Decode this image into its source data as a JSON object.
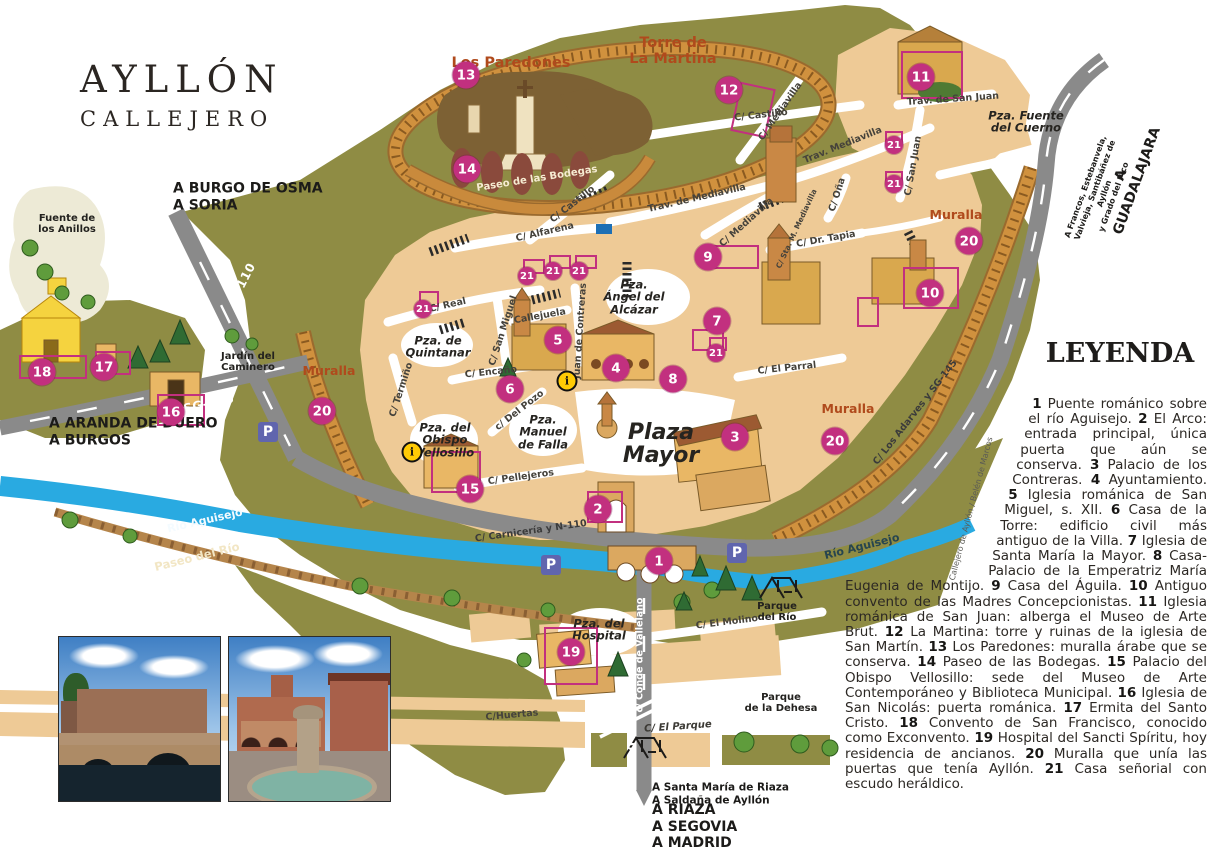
{
  "title": {
    "line1": "AYLLÓN",
    "line2": "CALLEJERO"
  },
  "legend": {
    "title": "LEYENDA",
    "items": [
      {
        "num": "1",
        "text": "Puente románico sobre el río Aguisejo."
      },
      {
        "num": "2",
        "text": "El Arco: entrada principal, única puerta que aún se conserva."
      },
      {
        "num": "3",
        "text": "Palacio de los Contreras."
      },
      {
        "num": "4",
        "text": "Ayuntamiento."
      },
      {
        "num": "5",
        "text": "Iglesia románica de San Miguel, s. XII."
      },
      {
        "num": "6",
        "text": "Casa de la Torre: edificio civil más antiguo de la Villa."
      },
      {
        "num": "7",
        "text": "Iglesia de Santa María la Mayor."
      },
      {
        "num": "8",
        "text": "Casa-Palacio de la Emperatriz María Eugenia de Montijo."
      },
      {
        "num": "9",
        "text": "Casa del Águila."
      },
      {
        "num": "10",
        "text": "Antiguo convento de las Madres Concepcionistas."
      },
      {
        "num": "11",
        "text": "Iglesia románica de San Juan: alberga el Museo de Arte Brut."
      },
      {
        "num": "12",
        "text": "La Martina: torre y ruinas de la iglesia de San Martín."
      },
      {
        "num": "13",
        "text": "Los Paredones: muralla árabe que se conserva."
      },
      {
        "num": "14",
        "text": "Paseo de las Bodegas."
      },
      {
        "num": "15",
        "text": "Palacio del Obispo Vellosillo: sede del Museo de Arte Contemporáneo y Biblioteca Municipal."
      },
      {
        "num": "16",
        "text": "Iglesia de San Nicolás: puerta románica."
      },
      {
        "num": "17",
        "text": "Ermita del Santo Cristo."
      },
      {
        "num": "18",
        "text": "Convento de San Francisco, conocido como Exconvento."
      },
      {
        "num": "19",
        "text": "Hospital del Sancti Spíritu, hoy residencia de ancianos."
      },
      {
        "num": "20",
        "text": "Muralla que unía las puertas que tenía Ayllón."
      },
      {
        "num": "21",
        "text": "Casa señorial con escudo heráldico."
      }
    ]
  },
  "colors": {
    "olive": "#8f8c44",
    "tan": "#eeca96",
    "muralla": "#d0913e",
    "muralla_dark": "#9a6a2e",
    "road": "#8a8a8a",
    "river": "#29aae1",
    "marker_pink": "#c2307f",
    "label_red": "#b04a1c",
    "parking_blue": "#6065ae",
    "info_yellow": "#ffcb05",
    "hill_brown": "#7d6134",
    "path_brown": "#b5854b",
    "building_gold": "#e9b765",
    "church_yellow": "#f5d33f",
    "tree_green": "#5f9c3c",
    "conifer_green": "#2f6b33"
  },
  "map": {
    "markers_large": [
      {
        "n": "1",
        "x": 659,
        "y": 561
      },
      {
        "n": "2",
        "x": 598,
        "y": 509
      },
      {
        "n": "3",
        "x": 735,
        "y": 437
      },
      {
        "n": "4",
        "x": 616,
        "y": 368
      },
      {
        "n": "5",
        "x": 558,
        "y": 340
      },
      {
        "n": "6",
        "x": 510,
        "y": 389
      },
      {
        "n": "7",
        "x": 717,
        "y": 321
      },
      {
        "n": "8",
        "x": 673,
        "y": 379
      },
      {
        "n": "9",
        "x": 708,
        "y": 257
      },
      {
        "n": "10",
        "x": 930,
        "y": 293
      },
      {
        "n": "11",
        "x": 921,
        "y": 77
      },
      {
        "n": "12",
        "x": 729,
        "y": 90
      },
      {
        "n": "13",
        "x": 466,
        "y": 75
      },
      {
        "n": "14",
        "x": 467,
        "y": 169
      },
      {
        "n": "15",
        "x": 470,
        "y": 489
      },
      {
        "n": "16",
        "x": 171,
        "y": 412
      },
      {
        "n": "17",
        "x": 104,
        "y": 367
      },
      {
        "n": "18",
        "x": 42,
        "y": 372
      },
      {
        "n": "19",
        "x": 571,
        "y": 652
      },
      {
        "n": "20",
        "x": 322,
        "y": 411
      },
      {
        "n": "20",
        "x": 835,
        "y": 441
      },
      {
        "n": "20",
        "x": 969,
        "y": 241
      }
    ],
    "markers_small": [
      {
        "n": "21",
        "x": 423,
        "y": 309
      },
      {
        "n": "21",
        "x": 527,
        "y": 276
      },
      {
        "n": "21",
        "x": 553,
        "y": 271
      },
      {
        "n": "21",
        "x": 579,
        "y": 271
      },
      {
        "n": "21",
        "x": 716,
        "y": 353
      },
      {
        "n": "21",
        "x": 894,
        "y": 145
      },
      {
        "n": "21",
        "x": 894,
        "y": 184
      }
    ],
    "info_icons": [
      {
        "x": 567,
        "y": 381
      },
      {
        "x": 412,
        "y": 452
      }
    ],
    "parking_icons": [
      {
        "x": 268,
        "y": 432
      },
      {
        "x": 551,
        "y": 565
      },
      {
        "x": 737,
        "y": 553
      }
    ],
    "labels": [
      {
        "text": "Paseo de las Bodegas",
        "x": 537,
        "y": 179,
        "rot": -9,
        "cls": "bodegas"
      },
      {
        "text": "C/ Castillo",
        "x": 573,
        "y": 205,
        "rot": -38,
        "cls": "street"
      },
      {
        "text": "C/ Castillo",
        "x": 761,
        "y": 116,
        "rot": -6,
        "cls": "street"
      },
      {
        "text": "Trav. de Mediavilla",
        "x": 697,
        "y": 199,
        "rot": -13,
        "cls": "street"
      },
      {
        "text": "Trav. Mediavilla",
        "x": 843,
        "y": 146,
        "rot": -22,
        "cls": "street"
      },
      {
        "text": "C/ Mediavilla",
        "x": 781,
        "y": 112,
        "rot": -55,
        "cls": "street"
      },
      {
        "text": "C/ Mediavilla",
        "x": 747,
        "y": 223,
        "rot": -42,
        "cls": "street"
      },
      {
        "text": "C/ Oña",
        "x": 838,
        "y": 195,
        "rot": -72,
        "cls": "street"
      },
      {
        "text": "C/ Sta. M. Mediavilla",
        "x": 797,
        "y": 229,
        "rot": -65,
        "cls": "street-tiny"
      },
      {
        "text": "C/ Dr. Tapia",
        "x": 826,
        "y": 240,
        "rot": -10,
        "cls": "street"
      },
      {
        "text": "C/ San Juan",
        "x": 914,
        "y": 166,
        "rot": -80,
        "cls": "street"
      },
      {
        "text": "Trav. de San Juan",
        "x": 953,
        "y": 100,
        "rot": -4,
        "cls": "street"
      },
      {
        "text": "C/ Alfarena",
        "x": 545,
        "y": 233,
        "rot": -13,
        "cls": "street"
      },
      {
        "text": "C/ Real",
        "x": 448,
        "y": 306,
        "rot": -13,
        "cls": "street"
      },
      {
        "text": "C/ San Miguel",
        "x": 504,
        "y": 331,
        "rot": -72,
        "cls": "street"
      },
      {
        "text": "Callejuela",
        "x": 540,
        "y": 317,
        "rot": -10,
        "cls": "street"
      },
      {
        "text": "Juan de Contreras",
        "x": 581,
        "y": 331,
        "rot": -86,
        "cls": "street"
      },
      {
        "text": "C/ Encaño",
        "x": 491,
        "y": 373,
        "rot": -6,
        "cls": "street"
      },
      {
        "text": "c/ Del Pozo",
        "x": 520,
        "y": 411,
        "rot": -38,
        "cls": "street"
      },
      {
        "text": "C/ Termiño",
        "x": 402,
        "y": 390,
        "rot": -72,
        "cls": "street"
      },
      {
        "text": "C/ Pellejeros",
        "x": 521,
        "y": 478,
        "rot": -8,
        "cls": "street"
      },
      {
        "text": "C/ El Parral",
        "x": 787,
        "y": 369,
        "rot": -6,
        "cls": "street"
      },
      {
        "text": "C/ El Molino",
        "x": 727,
        "y": 623,
        "rot": -7,
        "cls": "street"
      },
      {
        "text": "C/Huertas",
        "x": 512,
        "y": 716,
        "rot": -5,
        "cls": "street"
      },
      {
        "text": "C/ El Parque",
        "x": 678,
        "y": 727,
        "rot": -4,
        "cls": "street-it"
      },
      {
        "text": "C/ Carnicería y N-110",
        "x": 531,
        "y": 532,
        "rot": -8,
        "cls": "road-dark"
      },
      {
        "text": "C/ Los Adarves y SG-145",
        "x": 916,
        "y": 413,
        "rot": -52,
        "cls": "road-dark"
      },
      {
        "text": "N-110",
        "x": 243,
        "y": 283,
        "rot": -63,
        "cls": "road-label"
      },
      {
        "text": "SG-945",
        "x": 209,
        "y": 404,
        "rot": -12,
        "cls": "road-label"
      },
      {
        "text": "c/ Conde de Vallelano",
        "x": 641,
        "y": 655,
        "rot": -90,
        "cls": "road-label-sm"
      },
      {
        "text": "N-110",
        "x": 633,
        "y": 763,
        "rot": -90,
        "cls": "road-label"
      },
      {
        "text": "Río Aguisejo",
        "x": 205,
        "y": 521,
        "rot": -13,
        "cls": "river-label"
      },
      {
        "text": "Río Aguisejo",
        "x": 862,
        "y": 547,
        "rot": -14,
        "cls": "river-label-dark"
      },
      {
        "text": "Paseo del Río",
        "x": 197,
        "y": 557,
        "rot": -14,
        "cls": "path-label"
      },
      {
        "text": "Fuente de\nlos Anillos",
        "x": 67,
        "y": 224,
        "rot": 0,
        "cls": "small-place"
      },
      {
        "text": "Jardín del\nCaminero",
        "x": 248,
        "y": 362,
        "rot": 0,
        "cls": "small-place"
      },
      {
        "text": "Parque\ndel Río",
        "x": 777,
        "y": 612,
        "rot": 0,
        "cls": "small-place"
      },
      {
        "text": "Parque\nde la Dehesa",
        "x": 781,
        "y": 703,
        "rot": 0,
        "cls": "small-place"
      },
      {
        "text": "Pza. de\nQuintanar",
        "x": 438,
        "y": 347,
        "rot": 0,
        "cls": "plaza"
      },
      {
        "text": "Pza. del\nObispo\nVellosillo",
        "x": 445,
        "y": 440,
        "rot": 0,
        "cls": "plaza"
      },
      {
        "text": "Pza.\nManuel\nde Falla",
        "x": 543,
        "y": 432,
        "rot": 0,
        "cls": "plaza"
      },
      {
        "text": "Plaza\nMayor",
        "x": 661,
        "y": 444,
        "rot": 0,
        "cls": "plaza-lg"
      },
      {
        "text": "Pza.\nÁngel del\nAlcázar",
        "x": 634,
        "y": 297,
        "rot": 0,
        "cls": "plaza"
      },
      {
        "text": "Pza. del\nHospital",
        "x": 599,
        "y": 630,
        "rot": 0,
        "cls": "plaza"
      },
      {
        "text": "Pza. Fuente\ndel Cuerno",
        "x": 1026,
        "y": 122,
        "rot": 0,
        "cls": "plaza"
      },
      {
        "text": "Los Paredones",
        "x": 511,
        "y": 63,
        "rot": 0,
        "cls": "red"
      },
      {
        "text": "Torre de\nLa Martina",
        "x": 673,
        "y": 51,
        "rot": 0,
        "cls": "red"
      },
      {
        "text": "Muralla",
        "x": 329,
        "y": 371,
        "rot": 0,
        "cls": "red-sm"
      },
      {
        "text": "Muralla",
        "x": 848,
        "y": 409,
        "rot": 0,
        "cls": "red-sm"
      },
      {
        "text": "Muralla",
        "x": 956,
        "y": 215,
        "rot": 0,
        "cls": "red-sm"
      },
      {
        "text": "A BURGO DE OSMA\nA SORIA",
        "x": 173,
        "y": 197,
        "rot": 0,
        "cls": "dir",
        "anchor": "left"
      },
      {
        "text": "A ARANDA DE DUERO\nA BURGOS",
        "x": 49,
        "y": 432,
        "rot": 0,
        "cls": "dir",
        "anchor": "left"
      },
      {
        "text": "A GUADALAJARA",
        "x": 1129,
        "y": 178,
        "rot": -70,
        "cls": "dir"
      },
      {
        "text": "A Francos, Estebanvela,\nValvieja, Santibáñez de Ayllón\ny Grado del Pico",
        "x": 1100,
        "y": 192,
        "rot": -70,
        "cls": "dir-tiny"
      },
      {
        "text": "A Santa María de Riaza\nA Saldaña de Ayllón",
        "x": 652,
        "y": 794,
        "rot": 0,
        "cls": "dir-sm",
        "anchor": "left"
      },
      {
        "text": "A RIAZA\nA SEGOVIA\nA MADRID",
        "x": 652,
        "y": 827,
        "rot": 0,
        "cls": "dir",
        "anchor": "left"
      },
      {
        "text": "Callejero de Ayllón / Belén de Marcos",
        "x": 972,
        "y": 509,
        "rot": -75,
        "cls": "credit"
      }
    ]
  }
}
